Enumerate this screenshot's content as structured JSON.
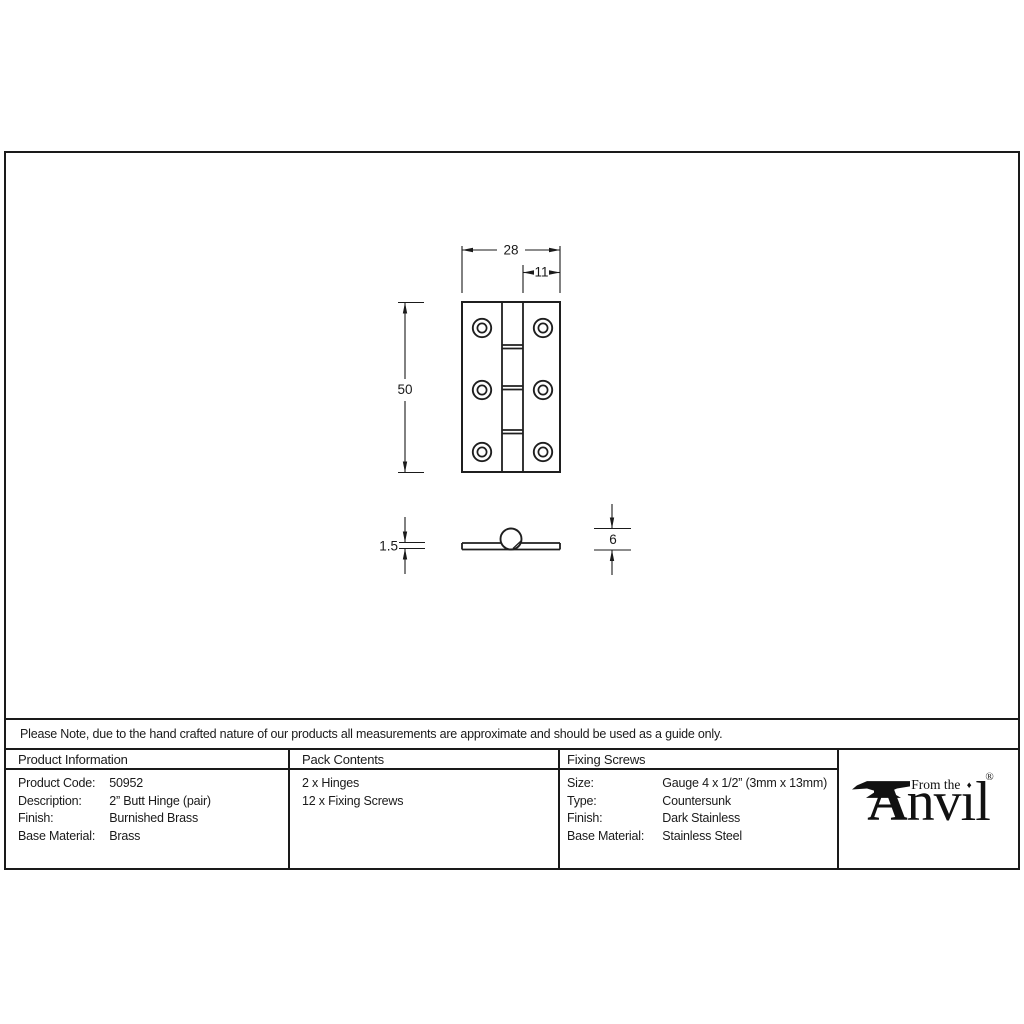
{
  "colors": {
    "line": "#1a1a1a",
    "text": "#1a1a1a",
    "background": "#ffffff"
  },
  "note": {
    "text": "Please Note, due to the hand crafted nature of our products all measurements are approximate and should be used as a guide only."
  },
  "drawing": {
    "dimensions": {
      "overall_width": "28",
      "leaf_width": "11",
      "height": "50",
      "thickness": "1.5",
      "knuckle_diameter": "6"
    }
  },
  "product_information": {
    "title": "Product Information",
    "rows": [
      {
        "label": "Product Code:",
        "value": "50952"
      },
      {
        "label": "Description:",
        "value": "2” Butt Hinge (pair)"
      },
      {
        "label": "Finish:",
        "value": "Burnished Brass"
      },
      {
        "label": "Base Material:",
        "value": "Brass"
      }
    ]
  },
  "pack_contents": {
    "title": "Pack Contents",
    "items": [
      "2 x Hinges",
      "12 x Fixing Screws"
    ]
  },
  "fixing_screws": {
    "title": "Fixing Screws",
    "rows": [
      {
        "label": "Size:",
        "value": "Gauge 4 x 1/2” (3mm x 13mm)"
      },
      {
        "label": "Type:",
        "value": "Countersunk"
      },
      {
        "label": "Finish:",
        "value": "Dark Stainless"
      },
      {
        "label": "Base Material:",
        "value": "Stainless Steel"
      }
    ]
  },
  "logo": {
    "tagline": "From the",
    "brand_initial": "A",
    "brand_rest": "nvıl",
    "i_dot": "♦",
    "registered_mark": "®"
  }
}
